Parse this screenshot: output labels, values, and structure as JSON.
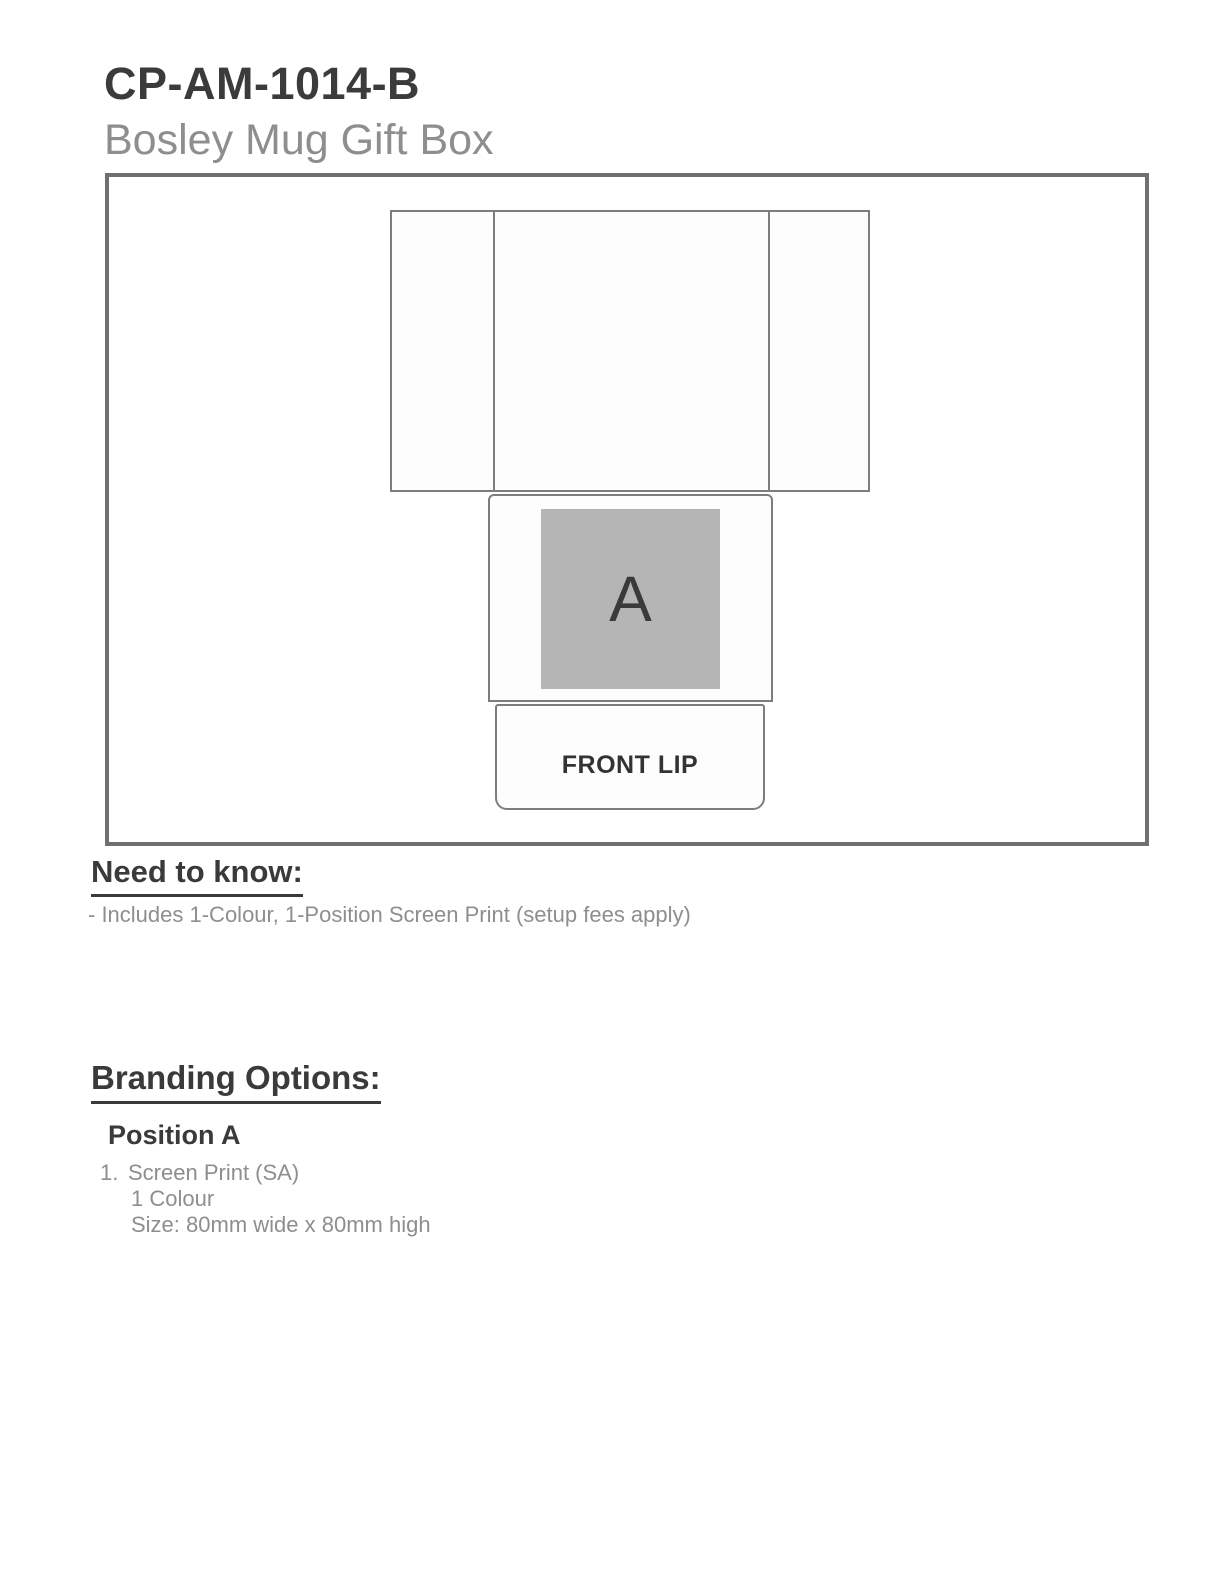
{
  "header": {
    "product_code": "CP-AM-1014-B",
    "product_name": "Bosley Mug Gift Box"
  },
  "diagram": {
    "position_label": "A",
    "front_lip_label": "FRONT LIP"
  },
  "need_to_know": {
    "heading": "Need to know:",
    "note": "- Includes 1-Colour, 1-Position Screen Print (setup fees apply)"
  },
  "branding_options": {
    "heading": "Branding Options:",
    "position_title": "Position A",
    "item_number": "1.",
    "item_method": "Screen Print (SA)",
    "item_colour": "1 Colour",
    "item_size": "Size: 80mm wide x 80mm high"
  },
  "colors": {
    "heading_text": "#3a3a3a",
    "muted_text": "#8e8e8e",
    "frame_border": "#6f6f6f",
    "dieline_stroke": "#7d7d7d",
    "print_area_fill": "#b5b5b5",
    "panel_fill": "#fdfdfd"
  }
}
